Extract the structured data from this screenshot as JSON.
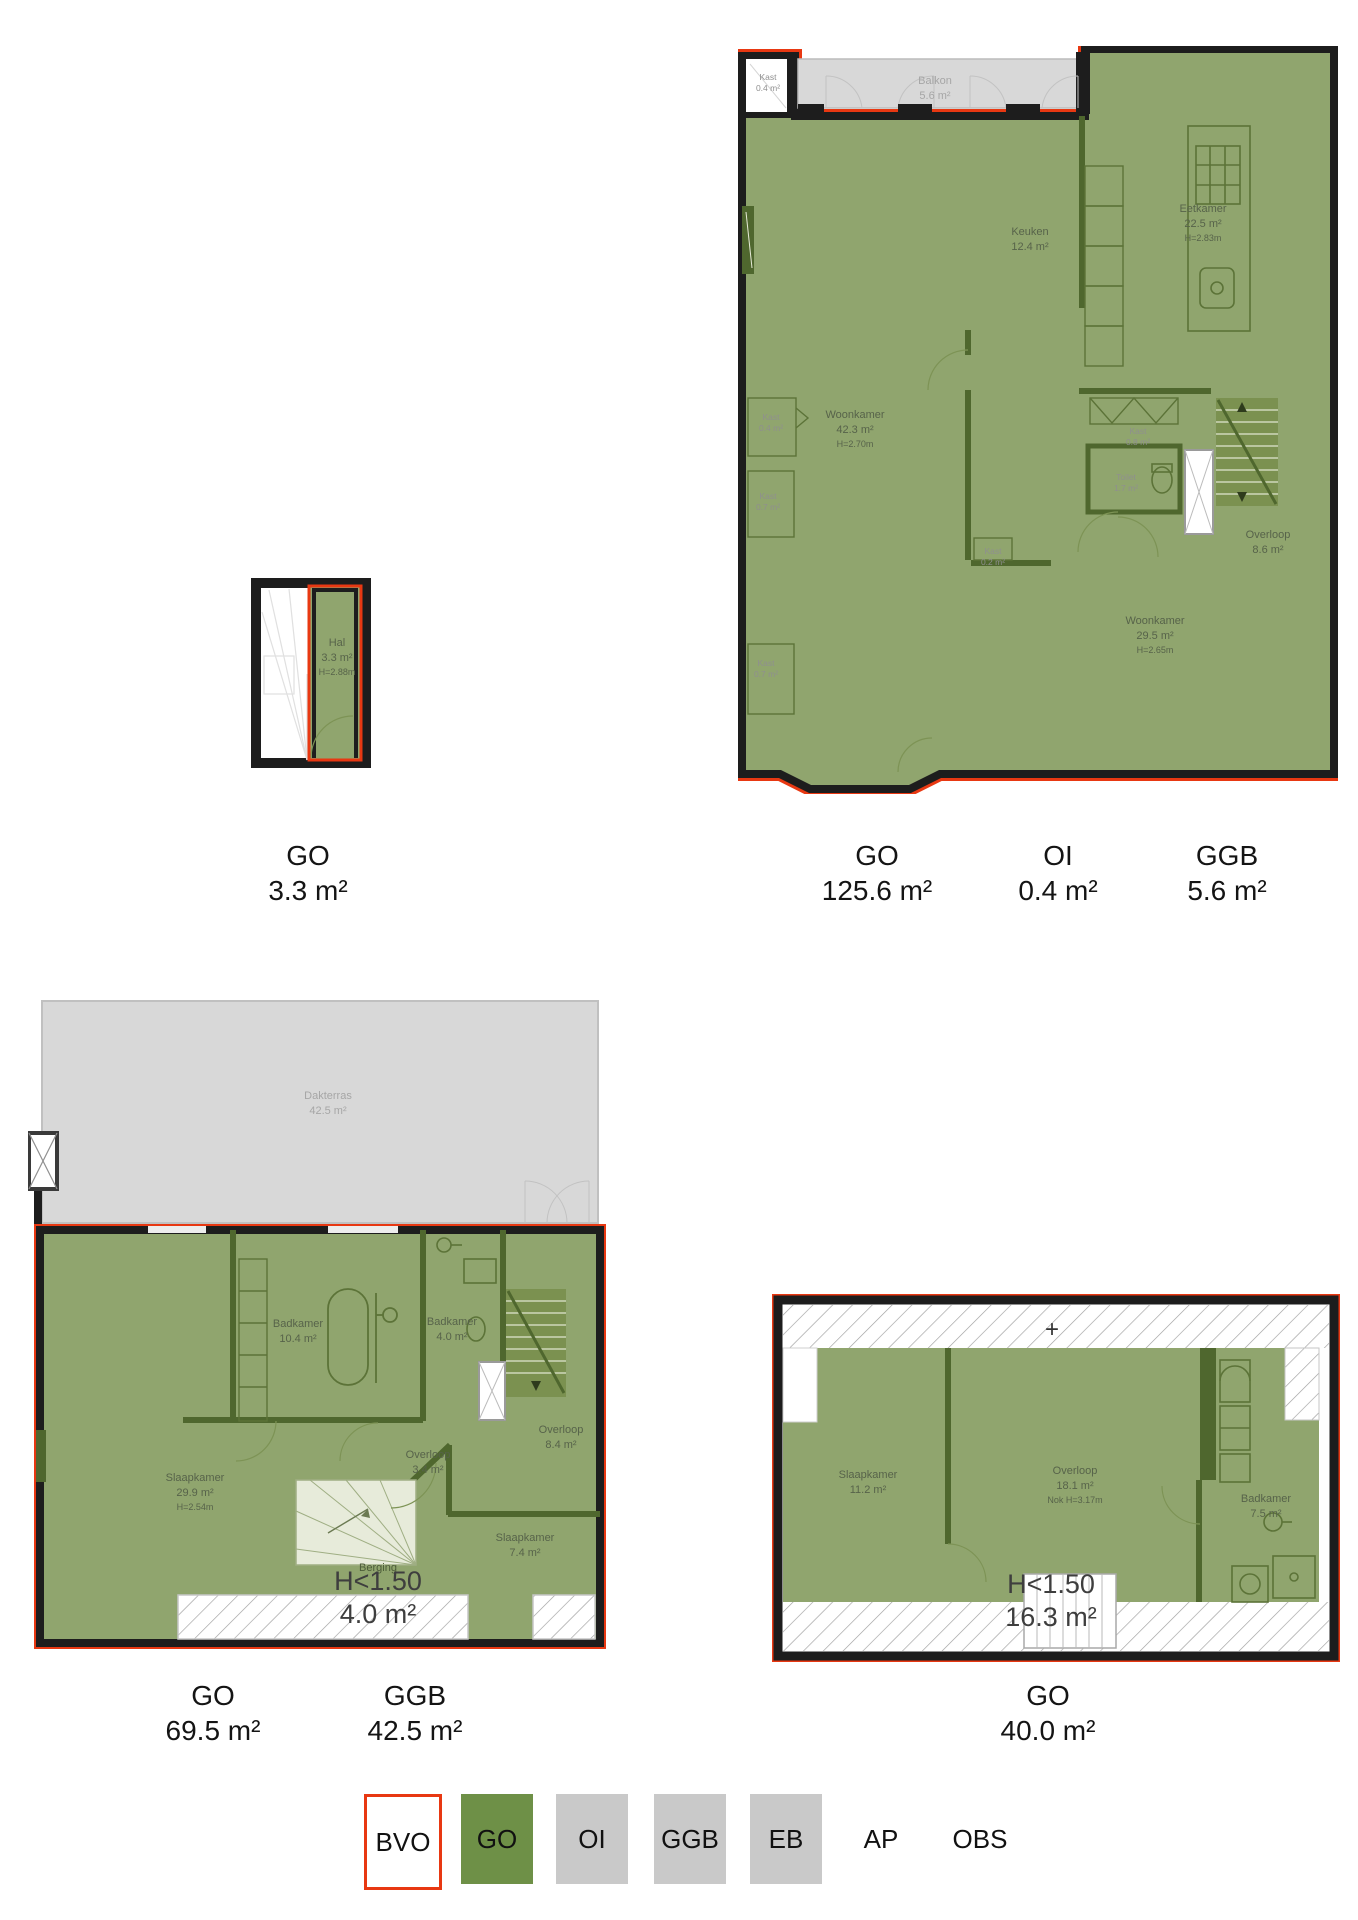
{
  "legend": {
    "bvo": "BVO",
    "go": "GO",
    "oi": "OI",
    "ggb": "GGB",
    "eb": "EB",
    "ap": "AP",
    "obs": "OBS"
  },
  "colors": {
    "bvo_red": "#e83812",
    "go_green": "#6e9047",
    "floor_green": "#90a56e",
    "outside_gray": "#d8d8d8",
    "legend_gray": "#c9c9c9",
    "wall_black": "#1d1d1d"
  },
  "plan1": {
    "hal": {
      "name": "Hal",
      "area": "3.3 m²",
      "height": "H=2.88m"
    },
    "summary": [
      {
        "label": "GO",
        "value": "3.3 m²"
      }
    ]
  },
  "plan2": {
    "balkon": {
      "name": "Balkon",
      "area": "5.6 m²"
    },
    "kast_oi": {
      "name": "Kast",
      "area": "0.4 m²"
    },
    "keuken": {
      "name": "Keuken",
      "area": "12.4 m²"
    },
    "eetkamer": {
      "name": "Eetkamer",
      "area": "22.5 m²",
      "height": "H=2.83m"
    },
    "woonkamer_voor": {
      "name": "Woonkamer",
      "area": "42.3 m²",
      "height": "H=2.70m"
    },
    "woonkamer_achter": {
      "name": "Woonkamer",
      "area": "29.5 m²",
      "height": "H=2.65m"
    },
    "toilet": {
      "name": "Toilet",
      "area": "1.7 m²"
    },
    "overloop": {
      "name": "Overloop",
      "area": "8.6 m²"
    },
    "kast_08": {
      "name": "Kast",
      "area": "0.8 m²"
    },
    "kast_links_1": {
      "name": "Kast",
      "area": "0.4 m²"
    },
    "kast_links_2": {
      "name": "Kast",
      "area": "0.7 m²"
    },
    "kast_links_3": {
      "name": "Kast",
      "area": "0.7 m²"
    },
    "kast_midden": {
      "name": "Kast",
      "area": "0.2 m²"
    },
    "summary": [
      {
        "label": "GO",
        "value": "125.6 m²"
      },
      {
        "label": "OI",
        "value": "0.4 m²"
      },
      {
        "label": "GGB",
        "value": "5.6 m²"
      }
    ]
  },
  "plan3": {
    "dakterras": {
      "name": "Dakterras",
      "area": "42.5 m²"
    },
    "badkamer_groot": {
      "name": "Badkamer",
      "area": "10.4 m²"
    },
    "badkamer_klein": {
      "name": "Badkamer",
      "area": "4.0 m²"
    },
    "slaapkamer_groot": {
      "name": "Slaapkamer",
      "area": "29.9 m²",
      "height": "H=2.54m"
    },
    "slaapkamer_klein": {
      "name": "Slaapkamer",
      "area": "7.4 m²"
    },
    "overloop_groot": {
      "name": "Overloop",
      "area": "8.4 m²"
    },
    "overloop_klein": {
      "name": "Overloop",
      "area": "3.4 m²"
    },
    "berging": {
      "name": "Berging"
    },
    "laag_plafond": {
      "label": "H<1.50",
      "value": "4.0 m²"
    },
    "summary": [
      {
        "label": "GO",
        "value": "69.5 m²"
      },
      {
        "label": "GGB",
        "value": "42.5 m²"
      }
    ]
  },
  "plan4": {
    "plus": "+",
    "slaapkamer": {
      "name": "Slaapkamer",
      "area": "11.2 m²"
    },
    "overloop": {
      "name": "Overloop",
      "area": "18.1 m²",
      "height": "Nok H=3.17m"
    },
    "badkamer": {
      "name": "Badkamer",
      "area": "7.5 m²"
    },
    "laag_plafond": {
      "label": "H<1.50",
      "value": "16.3 m²"
    },
    "summary": [
      {
        "label": "GO",
        "value": "40.0 m²"
      }
    ]
  }
}
